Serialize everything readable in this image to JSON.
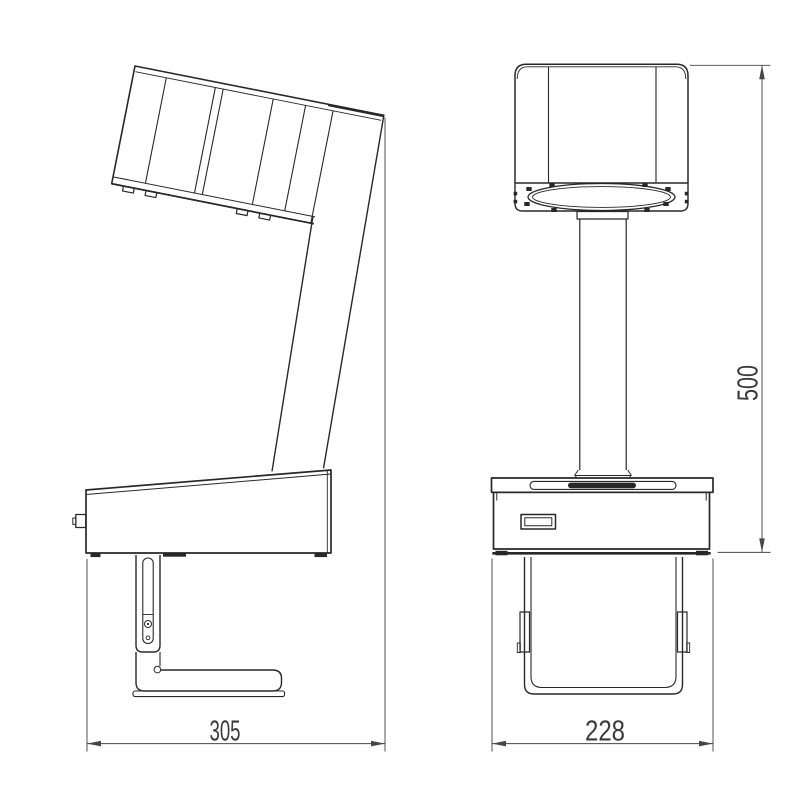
{
  "drawing": {
    "background": "#ffffff",
    "line_color": "#282828",
    "dimension_color": "#474747",
    "text_color": "#3a3a3a",
    "dimensions": {
      "depth": "305",
      "width": "228",
      "height": "500"
    }
  }
}
